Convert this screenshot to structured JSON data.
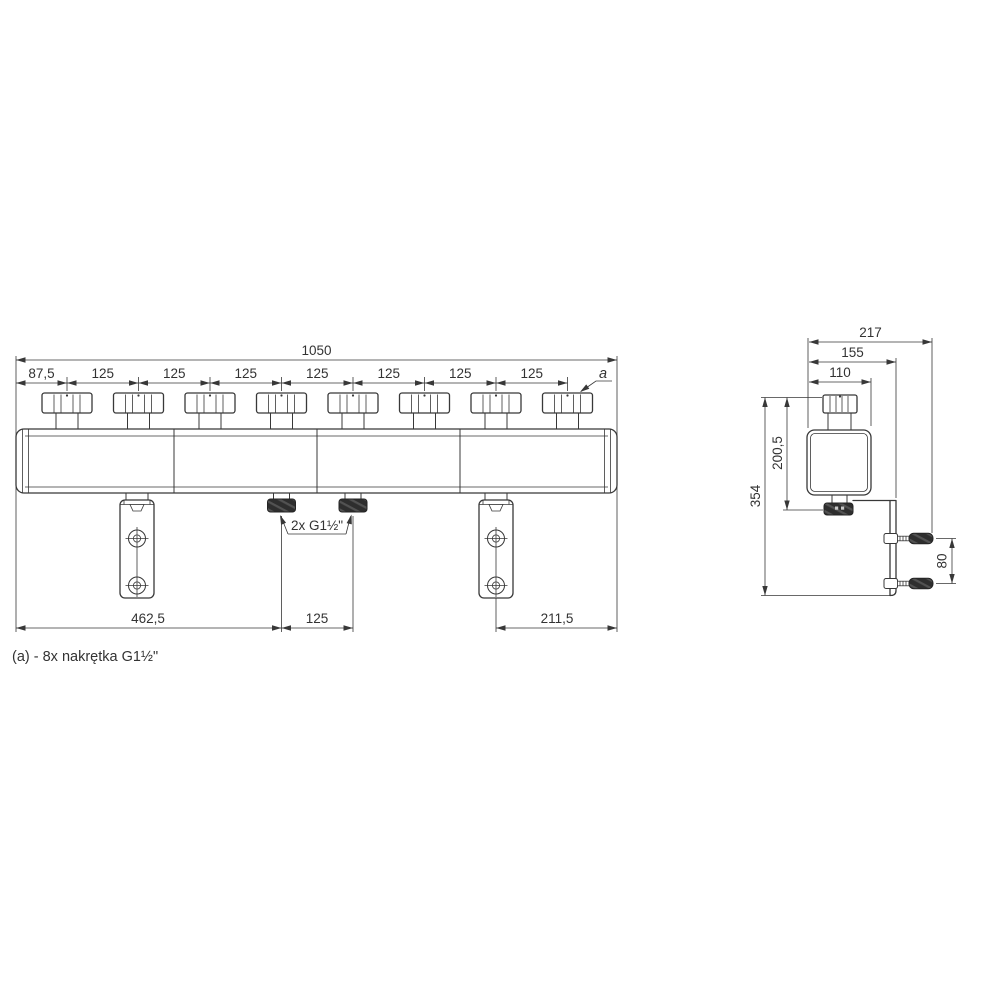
{
  "front_view": {
    "overall_length": "1050",
    "first_offset": "87,5",
    "pitches": [
      "125",
      "125",
      "125",
      "125",
      "125",
      "125",
      "125"
    ],
    "nut_callout": "a",
    "outlet_label": "2x G1½\"",
    "left_to_outlet": "462,5",
    "outlet_pitch": "125",
    "bracket_to_end": "211,5"
  },
  "side_view": {
    "total_depth": "217",
    "bracket_depth": "155",
    "body_width": "110",
    "total_height": "354",
    "body_height_from_top": "200,5",
    "anchor_spacing": "80"
  },
  "note": "(a) - 8x nakrętka G1½\"",
  "colors": {
    "line": "#383838",
    "dark_fitting": "#2e2e2e",
    "hatch_highlight": "#525252",
    "background": "#ffffff"
  }
}
